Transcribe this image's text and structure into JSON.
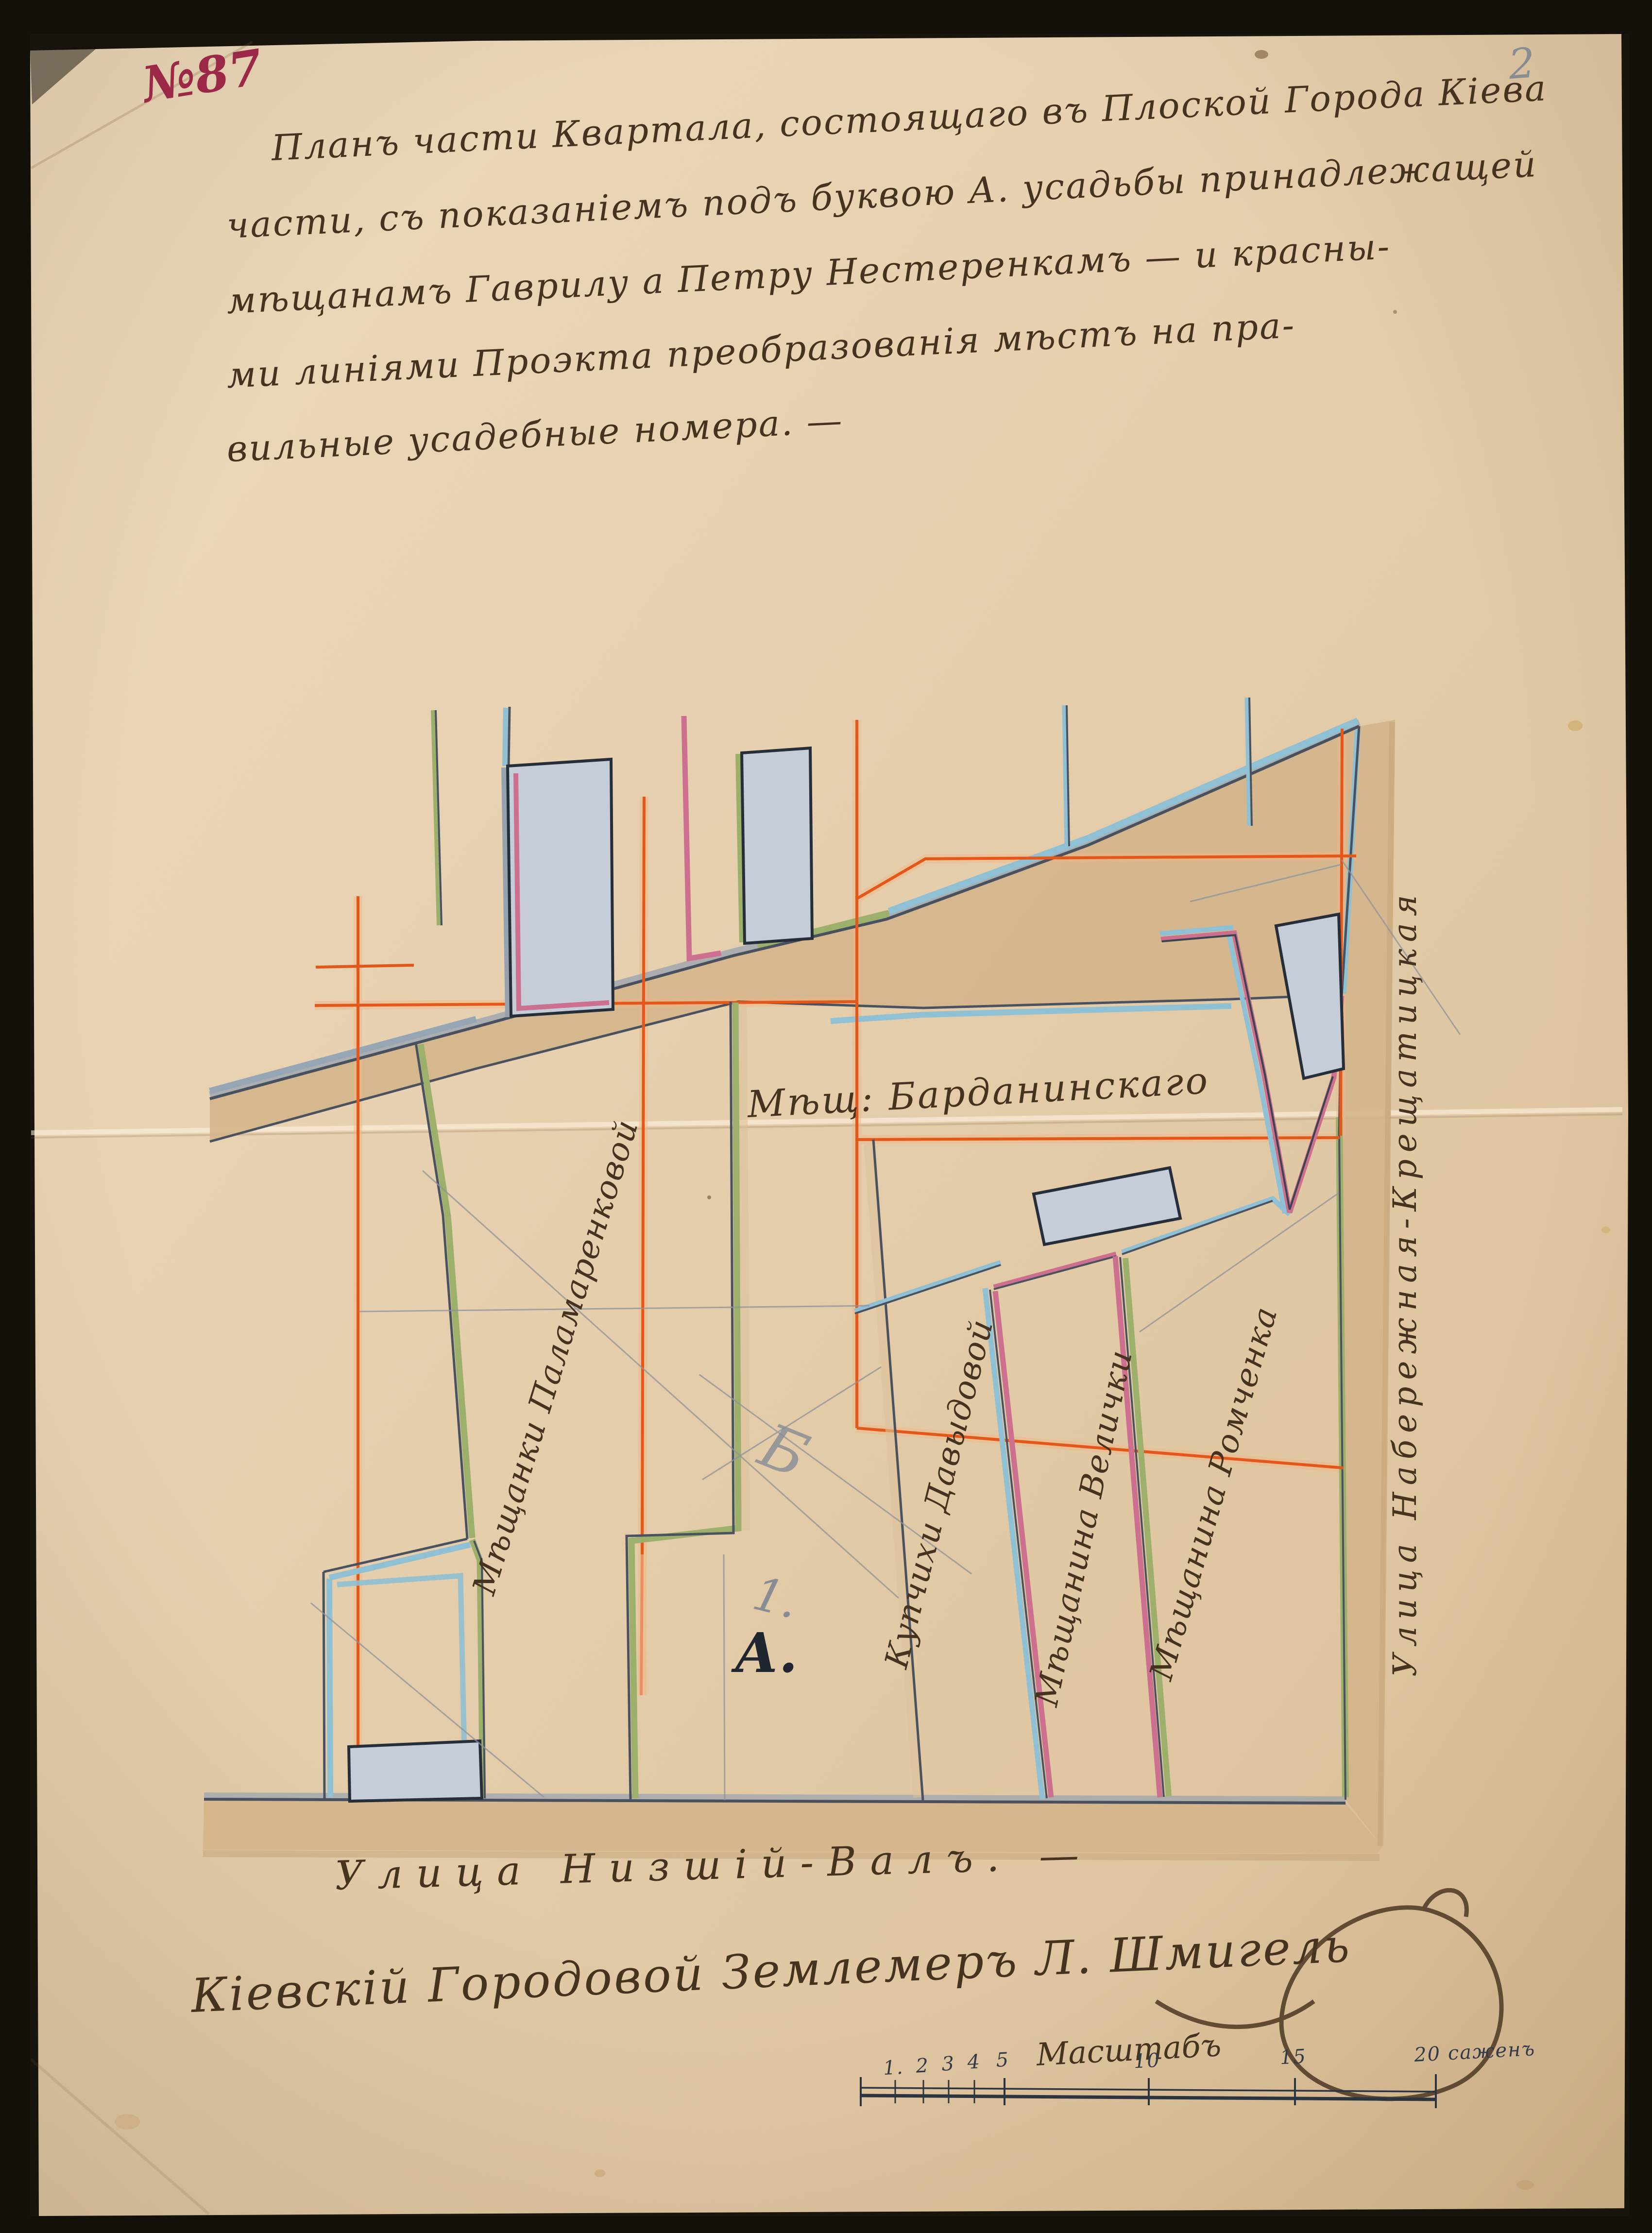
{
  "document": {
    "archive_number": "№87",
    "corner_pencil_number": "2",
    "title_lines": [
      "Планъ части Квартала, состоящаго въ Плоской Города Кіева",
      "части, съ показаніемъ подъ буквою А. усадьбы принадлежащей",
      "мѣщанамъ Гаврилу а Петру Нестеренкамъ — и красны-",
      "ми линіями Проэкта преобразованія мѣстъ на пра-",
      "вильные усадебные номера. —"
    ],
    "surveyor_signature": "Кіевскій Городовой Землемеръ Л. Шмигель"
  },
  "map": {
    "streets": {
      "bottom": "Улица Низшій-Валъ. —",
      "right": "Улица Набережная-Крещатицкая"
    },
    "plots": {
      "palamarenkova": "Мѣщанки Паламаренковой",
      "bardaninsky": "Мѣщ: Барданинскаго",
      "davydova": "Купчихи Давыдовой",
      "velichko": "Мѣщанина Велички",
      "romchenko": "Мѣщанина Ромченка"
    },
    "parcel_letter": "А.",
    "parcel_number_pencil": "1.",
    "pencil_mark": "Б",
    "legend_colors": {
      "project_red_line": "#e4571b",
      "blue_boundary": "#8fc0d4",
      "green_boundary": "#9cb06c",
      "pink_boundary": "#cd6f8e",
      "street_fill": "#d5b58b",
      "building_fill": "#c5ced8"
    }
  },
  "scale_bar": {
    "title": "Масштабъ",
    "tick_labels": [
      "1.",
      "2",
      "3",
      "4",
      "5",
      "10",
      "15",
      "20 саженъ"
    ]
  }
}
